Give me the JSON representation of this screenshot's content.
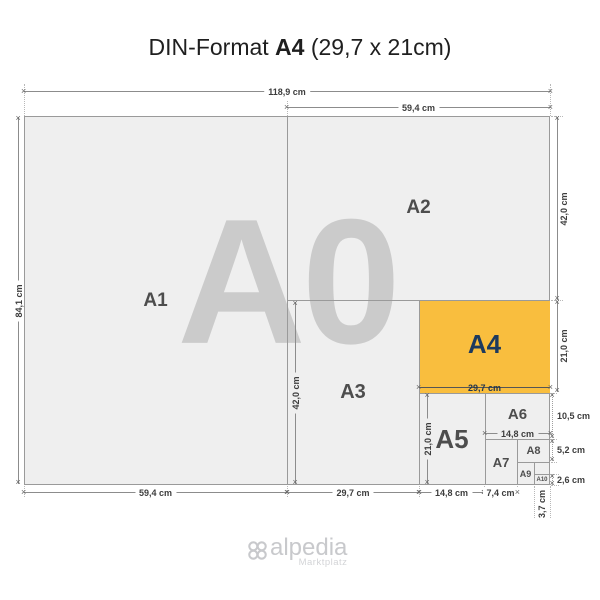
{
  "title": {
    "prefix": "DIN-Format ",
    "highlight": "A4",
    "suffix": " (29,7 x 21cm)"
  },
  "watermark": "A0",
  "sheets": {
    "a1": "A1",
    "a2": "A2",
    "a3": "A3",
    "a4": "A4",
    "a5": "A5",
    "a6": "A6",
    "a7": "A7",
    "a8": "A8",
    "a9": "A9",
    "a10": "A10"
  },
  "dims": {
    "top_width": "118,9 cm",
    "top_right_width": "59,4 cm",
    "left_height": "84,1 cm",
    "right_a2_height": "42,0 cm",
    "right_a4_height": "21,0 cm",
    "right_a6_height": "10,5 cm",
    "right_a8_height": "5,2 cm",
    "right_a10_height": "2,6 cm",
    "bottom_a1_width": "59,4 cm",
    "bottom_a3_width": "29,7 cm",
    "bottom_a5_width": "14,8 cm",
    "bottom_a7_width": "7,4 cm",
    "bottom_a10_width": "3,7 cm",
    "inside_a4_width": "29,7 cm",
    "inside_a6_width": "14,8 cm",
    "inside_a5_height": "21,0 cm",
    "inside_a3_height": "42,0 cm"
  },
  "logo": {
    "name": "alpedia",
    "tagline": "Marktplatz"
  },
  "colors": {
    "highlight": "#F9BE3E",
    "paper": "#EFEFEF",
    "border": "#9A9A9A",
    "label_navy": "#1D3A5E",
    "watermark": "#CBCBCB"
  }
}
